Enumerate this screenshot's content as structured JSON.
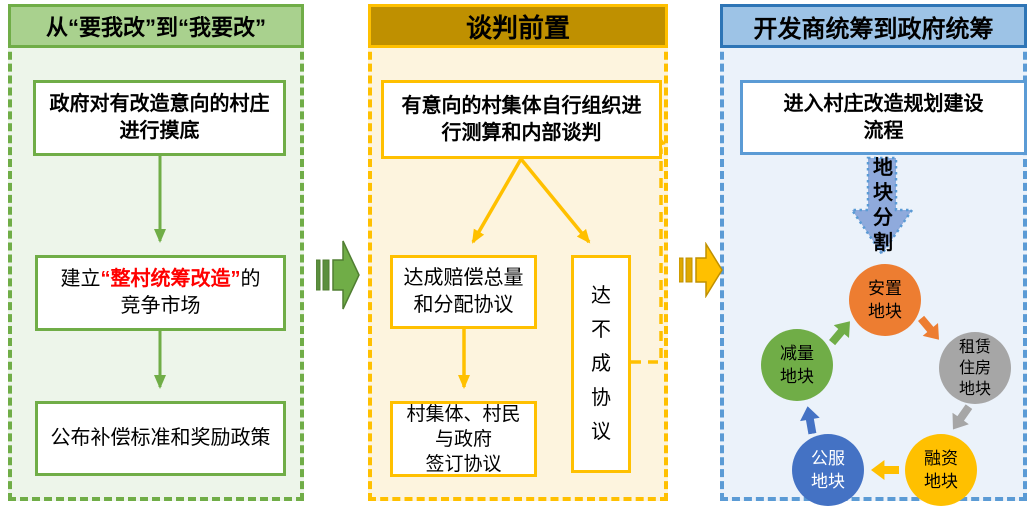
{
  "palette": {
    "green": "#70AD47",
    "green_header": "#A9D18E",
    "green_bg": "#EDF5EA",
    "gold": "#FFC000",
    "gold_dark": "#BF9000",
    "gold_bg": "#FDF4DE",
    "blue": "#5B9BD5",
    "blue_dark": "#2E75B6",
    "blue_header": "#9DC3E6",
    "blue_bg": "#EBF2FA",
    "split_arrow_fill": "#8FAADC",
    "highlight_red": "#FF0000",
    "cycle_orange": "#ED7D31",
    "cycle_gray": "#A6A6A6",
    "cycle_gold": "#FFC000",
    "cycle_blue": "#4472C4",
    "cycle_green": "#70AD47"
  },
  "panel_left": {
    "title": "从“要我改”到“我要改”",
    "box1_lines": [
      "政府对有改造意向的村庄",
      "进行摸底"
    ],
    "box2": {
      "prefix": "建立",
      "highlight": "“整村统筹改造”",
      "suffix": "的",
      "line2": "竞争市场"
    },
    "box3": "公布补偿标准和奖励政策"
  },
  "panel_middle": {
    "title": "谈判前置",
    "box1_lines": [
      "有意向的村集体自行组织进",
      "行测算和内部谈判"
    ],
    "box2_lines": [
      "达成赔偿总量",
      "和分配协议"
    ],
    "box3_lines": [
      "村集体、村民",
      "与政府",
      "签订协议"
    ],
    "fail_box": "达不成协议"
  },
  "panel_right": {
    "title": "开发商统筹到政府统筹",
    "box1_lines": [
      "进入村庄改造规划建设",
      "流程"
    ],
    "split_label": "地块分割",
    "cycle": [
      {
        "label": "安置地块",
        "lines": [
          "安置",
          "地块"
        ],
        "color": "#ED7D31",
        "text_color": "#000000"
      },
      {
        "label": "租赁住房地块",
        "lines": [
          "租赁",
          "住房",
          "地块"
        ],
        "color": "#A6A6A6",
        "text_color": "#000000"
      },
      {
        "label": "融资地块",
        "lines": [
          "融资",
          "地块"
        ],
        "color": "#FFC000",
        "text_color": "#000000"
      },
      {
        "label": "公服地块",
        "lines": [
          "公服",
          "地块"
        ],
        "color": "#4472C4",
        "text_color": "#FFFFFF"
      },
      {
        "label": "减量地块",
        "lines": [
          "减量",
          "地块"
        ],
        "color": "#70AD47",
        "text_color": "#000000"
      }
    ]
  }
}
